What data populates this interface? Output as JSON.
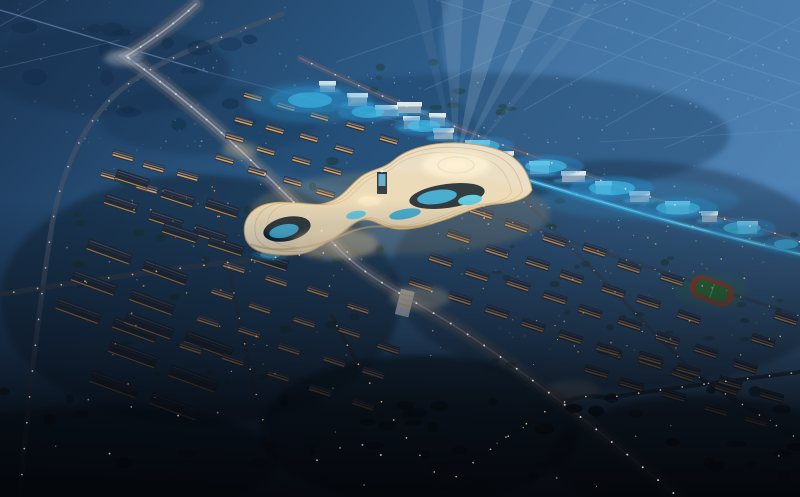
{
  "meta": {
    "title": "Night aerial rendering of a city master plan: curvilinear illuminated mall complex with searchlight beams, expressway, warehouse district, apartment blocks and sports field",
    "width": 800,
    "height": 497
  },
  "palette": {
    "skyTop1": "#1a3453",
    "skyTop2": "#2c5a86",
    "skyTop3": "#4d82b4",
    "skyWash": "#5c8fc0",
    "fieldLine": "#7fa3cc",
    "landmarkCream": "#eadfc6",
    "landmarkCreamBright": "#f4ecd8",
    "landmarkGold": "#c8a166",
    "landmarkCourtyard": "#0e2134",
    "landmarkPool": "#2aa9e0",
    "landmarkPoolBright": "#49ccf2",
    "landmarkGlass": "#8ab8dc",
    "towerDark": "#16243a",
    "screenBlue": "#4db6e8",
    "trackRed": "#8d4a35",
    "pitchGreen": "#2f7a3d",
    "roundaboutStroke": "#323c50",
    "whiteBuilding": "#c8d2de",
    "warmWindow": "#eead5c",
    "pondColor": "#2b86c4",
    "pondCore": "#45c8f0"
  },
  "scene": {
    "fieldLines": [
      [
        436,
        0,
        800,
        110,
        0.25,
        1.2
      ],
      [
        530,
        0,
        800,
        84,
        0.3,
        1.3
      ],
      [
        628,
        0,
        800,
        60,
        0.25,
        1.2
      ],
      [
        712,
        0,
        800,
        32,
        0.2,
        1.1
      ],
      [
        520,
        0,
        336,
        62,
        0.22,
        1.1
      ],
      [
        624,
        0,
        424,
        90,
        0.25,
        1.2
      ],
      [
        716,
        0,
        524,
        110,
        0.25,
        1.2
      ],
      [
        800,
        18,
        606,
        126,
        0.22,
        1.1
      ],
      [
        800,
        92,
        664,
        148,
        0.2,
        1.1
      ],
      [
        600,
        142,
        800,
        130,
        0.18,
        1.0
      ],
      [
        0,
        10,
        208,
        72,
        0.5,
        1.4
      ],
      [
        208,
        72,
        448,
        134,
        0.22,
        1.1
      ],
      [
        0,
        68,
        120,
        40,
        0.25,
        1.0
      ],
      [
        46,
        0,
        0,
        26,
        0.25,
        1.0
      ]
    ],
    "terrain": [
      [
        110,
        70,
        120,
        45,
        "#142e4b",
        0.4
      ],
      [
        210,
        120,
        110,
        35,
        "#16314f",
        0.35
      ],
      [
        480,
        135,
        250,
        62,
        "#1e4266",
        0.45
      ],
      [
        620,
        275,
        230,
        115,
        "#182c42",
        0.4
      ],
      [
        200,
        300,
        200,
        125,
        "#0d1b2b",
        0.45
      ],
      [
        420,
        430,
        160,
        75,
        "#05090f",
        0.55
      ],
      [
        700,
        458,
        150,
        62,
        "#05090f",
        0.5
      ],
      [
        100,
        460,
        180,
        55,
        "#04080d",
        0.5
      ]
    ],
    "roads": [
      {
        "n": "ring-road",
        "d": "M282,14 C210,42 150,62 115,95 C82,126 62,170 52,225 C40,300 28,400 20,497",
        "w": 5,
        "c": "#3e5068",
        "o": 0.8,
        "gap": 26,
        "lampC": "#cfdce8",
        "lampR": 0.9,
        "lampO": 0.75
      },
      {
        "n": "industrial-avenue",
        "d": "M2,294 C90,280 200,264 300,255 C330,252 350,251 368,253",
        "w": 5,
        "c": "#333f52",
        "o": 0.85,
        "gap": 24,
        "lampC": "#e3d7ae",
        "lampR": 0.9,
        "lampO": 0.8
      },
      {
        "n": "industrial-street",
        "d": "M212,178 C222,228 230,278 242,330 C250,372 260,412 270,444",
        "w": 4,
        "c": "#2c3749",
        "o": 0.75,
        "gap": 26,
        "lampC": "#ddd2a8",
        "lampR": 0.8,
        "lampO": 0.7
      },
      {
        "n": "foreground-road-nw",
        "d": "M332,316 C346,344 358,364 374,390 C398,428 420,458 442,480",
        "w": 4,
        "c": "#283246",
        "o": 0.85,
        "gap": 22,
        "lampC": "#e6d9a8",
        "lampR": 0.85,
        "lampO": 0.8
      },
      {
        "n": "foreground-road-ne",
        "d": "M448,484 C472,462 502,440 532,420 C558,402 582,392 606,398",
        "w": 4.5,
        "c": "#283246",
        "o": 0.85,
        "gap": 22,
        "lampC": "#e6d9a8",
        "lampR": 0.85,
        "lampO": 0.8
      },
      {
        "n": "foreground-road-east",
        "d": "M606,398 C670,388 736,380 800,372",
        "w": 4,
        "c": "#283246",
        "o": 0.8,
        "gap": 22,
        "lampC": "#e6d9a8",
        "lampR": 0.85,
        "lampO": 0.8
      },
      {
        "n": "foreground-road-se",
        "d": "M700,378 C732,398 764,418 800,440",
        "w": 4,
        "c": "#283246",
        "o": 0.75,
        "gap": 20,
        "lampC": "#e6d9a8",
        "lampR": 0.8,
        "lampO": 0.75
      },
      {
        "n": "residential-street-a",
        "d": "M470,208 C540,232 620,258 700,284 C740,297 772,307 800,316",
        "w": 3.5,
        "c": "#3a465c",
        "o": 0.6,
        "gap": 30,
        "lampC": "#cdd6de",
        "lampR": 0.7,
        "lampO": 0.6
      },
      {
        "n": "residential-street-b",
        "d": "M520,196 C560,236 600,276 640,318 C662,342 682,360 700,378",
        "w": 3.5,
        "c": "#3a465c",
        "o": 0.6,
        "gap": 30,
        "lampC": "#cdd6de",
        "lampR": 0.7,
        "lampO": 0.6
      },
      {
        "n": "northeast-avenue",
        "d": "M300,58 C370,92 432,118 492,141 C560,166 640,196 720,218 C762,229 786,236 800,242",
        "w": 6,
        "c": "#4a5870",
        "o": 0.9,
        "gap": 26,
        "lampC": "#dfe6ec",
        "lampR": 0.9,
        "lampO": 0.8,
        "center": {
          "c": "#9fb0c0",
          "w": 1,
          "o": 0.35
        }
      },
      {
        "n": "cyan-light-strip",
        "d": "M436,152 C520,178 600,202 680,224 C722,235 766,246 800,254",
        "w": 4,
        "c": "#3ec7f5",
        "o": 0.55,
        "gap": 0,
        "glow": {
          "c": "#2f9fd8",
          "w": 10,
          "o": 0.25
        },
        "center": {
          "c": "#8fe4ff",
          "w": 1.2,
          "o": 0.7
        }
      },
      {
        "n": "main-expressway",
        "d": "M196,4 C170,28 146,44 126,56 C162,82 202,114 238,148 C274,182 308,216 338,248 C368,280 412,298 464,332 C522,370 602,432 678,497",
        "w": 9,
        "c": "#5a6680",
        "o": 0.95,
        "gap": 20,
        "lampC": "#e8e4d0",
        "lampR": 1.0,
        "lampO": 0.85,
        "glow": {
          "c": "#b89868",
          "w": 16,
          "o": 0.18
        },
        "center": {
          "c": "#d8d4c4",
          "w": 1.6,
          "o": 0.55
        }
      }
    ],
    "clusters": [
      {
        "t": "a",
        "x0": 245,
        "y0": 92,
        "cols": 5,
        "rows": 4,
        "cvx": 34,
        "cvy": 10,
        "rvx": -10,
        "rvy": 21,
        "w": 19,
        "h": 7,
        "rot": 16,
        "clip": ""
      },
      {
        "t": "a",
        "x0": 112,
        "y0": 148,
        "cols": 3,
        "rows": 2,
        "cvx": 32,
        "cvy": 10,
        "rvx": -8,
        "rvy": 22,
        "w": 22,
        "h": 8,
        "rot": 16,
        "clip": ""
      },
      {
        "t": "w",
        "x0": 120,
        "y0": 170,
        "cols": 3,
        "rows": 2,
        "cvx": 44,
        "cvy": 15,
        "rvx": -12,
        "rvy": 25,
        "w": 34,
        "h": 11,
        "rot": 18,
        "clip": ""
      },
      {
        "t": "w",
        "x0": 165,
        "y0": 222,
        "cols": 3,
        "rows": 1,
        "cvx": 46,
        "cvy": 15,
        "rvx": 0,
        "rvy": 0,
        "w": 36,
        "h": 11,
        "rot": 18,
        "clip": ""
      },
      {
        "t": "w",
        "x0": 88,
        "y0": 240,
        "cols": 2,
        "rows": 3,
        "cvx": 58,
        "cvy": 20,
        "rvx": -16,
        "rvy": 28,
        "w": 46,
        "h": 12,
        "rot": 20,
        "clip": ""
      },
      {
        "t": "w",
        "x0": 130,
        "y0": 312,
        "cols": 2,
        "rows": 3,
        "cvx": 60,
        "cvy": 20,
        "rvx": -18,
        "rvy": 30,
        "w": 50,
        "h": 13,
        "rot": 20,
        "clip": ""
      },
      {
        "t": "a",
        "x0": 225,
        "y0": 258,
        "cols": 5,
        "rows": 4,
        "cvx": 42,
        "cvy": 14,
        "rvx": -14,
        "rvy": 27,
        "w": 23,
        "h": 8,
        "rot": 18,
        "clip": "west"
      },
      {
        "t": "a",
        "x0": 470,
        "y0": 205,
        "cols": 9,
        "rows": 4,
        "cvx": 38,
        "cvy": 13,
        "rvx": -20,
        "rvy": 24,
        "w": 24,
        "h": 9,
        "rot": 18,
        "clip": "east"
      },
      {
        "t": "a",
        "x0": 600,
        "y0": 340,
        "cols": 5,
        "rows": 2,
        "cvx": 40,
        "cvy": 12,
        "rvx": -16,
        "rvy": 26,
        "w": 24,
        "h": 9,
        "rot": 16,
        "clip": "east"
      }
    ],
    "exclusions": [
      {
        "cx": 712,
        "cy": 291,
        "r": 34
      },
      {
        "cx": 395,
        "cy": 200,
        "r": 60
      }
    ],
    "cubes": {
      "list": [
        [
          320,
          81
        ],
        [
          348,
          93
        ],
        [
          376,
          105
        ],
        [
          404,
          116
        ],
        [
          434,
          128
        ],
        [
          466,
          140
        ],
        [
          498,
          151
        ],
        [
          530,
          161
        ],
        [
          562,
          171
        ],
        [
          596,
          181
        ],
        [
          630,
          191
        ],
        [
          666,
          201
        ],
        [
          702,
          211
        ],
        [
          738,
          221
        ],
        [
          398,
          102
        ],
        [
          430,
          113
        ]
      ],
      "top": "#dde8ea",
      "side": "#8fa6bb",
      "glow": "#3ec1f2"
    },
    "ponds": [
      [
        310,
        100,
        40,
        13
      ],
      [
        368,
        112,
        30,
        10
      ],
      [
        424,
        126,
        30,
        10
      ],
      [
        482,
        146,
        32,
        10
      ],
      [
        546,
        166,
        38,
        11
      ],
      [
        612,
        188,
        42,
        12
      ],
      [
        678,
        208,
        40,
        11
      ],
      [
        742,
        228,
        34,
        10
      ],
      [
        786,
        244,
        22,
        8
      ],
      [
        270,
        255,
        18,
        6
      ]
    ],
    "blobRegions": [
      [
        60,
        150,
        320,
        250,
        26,
        3,
        7,
        "#17301f",
        0.5,
        11
      ],
      [
        430,
        200,
        370,
        170,
        30,
        2.5,
        6,
        "#1c3a26",
        0.5,
        23
      ],
      [
        430,
        205,
        360,
        160,
        26,
        0.8,
        1.7,
        "#76b25c",
        0.8,
        31
      ],
      [
        0,
        390,
        800,
        100,
        46,
        4,
        10,
        "#0a140f",
        0.85,
        41
      ],
      [
        0,
        15,
        270,
        140,
        18,
        6,
        14,
        "#122c49",
        0.55,
        51
      ],
      [
        300,
        60,
        220,
        55,
        12,
        3,
        7,
        "#1d3a2a",
        0.5,
        61
      ]
    ],
    "dotRegions": [
      [
        0,
        0,
        300,
        150,
        70,
        0.4,
        1.0,
        "#8fb0d4",
        0.5,
        3
      ],
      [
        520,
        0,
        280,
        150,
        85,
        0.4,
        1.0,
        "#a9c6e6",
        0.55,
        5
      ],
      [
        90,
        135,
        680,
        140,
        65,
        0.4,
        1.0,
        "#d8e4ee",
        0.45,
        9
      ],
      [
        430,
        215,
        360,
        150,
        55,
        0.4,
        1.0,
        "#f2c97e",
        0.8,
        13
      ],
      [
        60,
        160,
        300,
        230,
        45,
        0.4,
        1.0,
        "#edbb6f",
        0.7,
        19
      ],
      [
        40,
        395,
        740,
        92,
        22,
        0.5,
        1.1,
        "#e6ddb2",
        0.8,
        17
      ],
      [
        300,
        70,
        210,
        70,
        25,
        0.4,
        0.9,
        "#9fd0e8",
        0.7,
        29
      ]
    ],
    "glows": [
      [
        400,
        213,
        150,
        42,
        "#f5c87a",
        0.16
      ],
      [
        336,
        244,
        42,
        16,
        "#ffe9c2",
        0.42
      ],
      [
        420,
        298,
        30,
        12,
        "#ffe9c2",
        0.36
      ],
      [
        456,
        165,
        34,
        13,
        "#fff4d6",
        0.75
      ],
      [
        369,
        201,
        14,
        6,
        "#ffecc0",
        0.6
      ],
      [
        124,
        58,
        20,
        8,
        "#e8eef4",
        0.3
      ],
      [
        310,
        103,
        64,
        20,
        "#2f9fd8",
        0.28
      ],
      [
        640,
        200,
        100,
        20,
        "#2f9fd8",
        0.2
      ],
      [
        712,
        291,
        36,
        18,
        "#3e8a4c",
        0.22
      ],
      [
        573,
        390,
        26,
        10,
        "#ffe9c2",
        0.3
      ],
      [
        240,
        150,
        18,
        8,
        "#f0d9a0",
        0.25
      ]
    ],
    "beams": [
      [
        456,
        163,
        420,
        0,
        7,
        0.06
      ],
      [
        456,
        163,
        452,
        0,
        11,
        0.11
      ],
      [
        456,
        163,
        498,
        0,
        14,
        0.17
      ],
      [
        458,
        165,
        544,
        0,
        10,
        0.12
      ],
      [
        460,
        168,
        592,
        4,
        8,
        0.07
      ]
    ],
    "building": {
      "apartmentRoof": "#28334a",
      "apartmentRidge": "#44536e",
      "win1": "#eead5c",
      "win2": "#f5cf8a",
      "warehouseRoof": "#202b3b",
      "warehouseRidge1": "#4e5c74",
      "warehouseRidge2": "#3a4860",
      "warehouseEave": "#d29a4e"
    }
  }
}
